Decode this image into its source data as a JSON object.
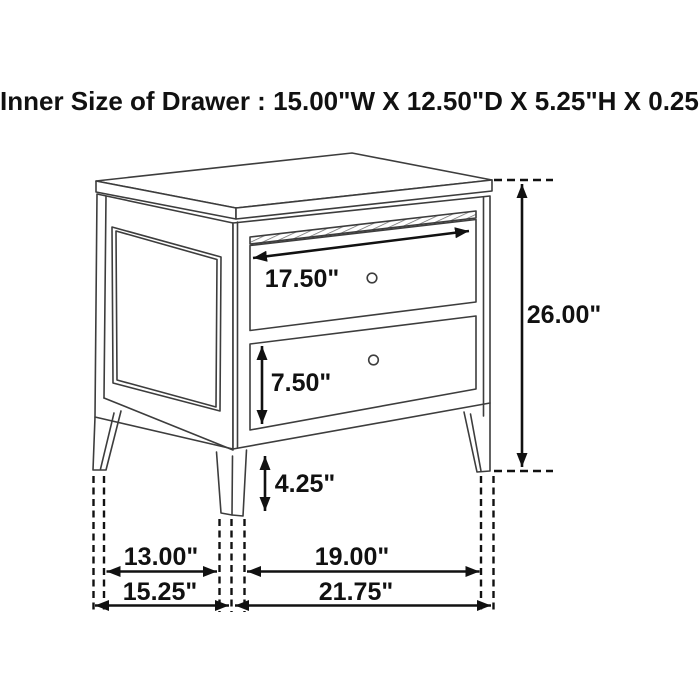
{
  "header": {
    "title": "Inner Size of Drawer : 15.00\"W X 12.50\"D X 5.25\"H X 0.25\"T"
  },
  "diagram": {
    "type": "furniture-dimension-line-drawing",
    "subject": "two-drawer nightstand",
    "drawer_count": 2,
    "dimensions": {
      "top_drawer_width": "17.50\"",
      "bottom_drawer_height": "7.50\"",
      "leg_height": "4.25\"",
      "overall_height": "26.00\"",
      "side_leg_spacing": "13.00\"",
      "front_leg_spacing": "19.00\"",
      "overall_depth": "15.25\"",
      "overall_width": "21.75\""
    },
    "colors": {
      "background": "#ffffff",
      "furniture_line": "#3d3d3d",
      "dimension_line": "#111111"
    }
  }
}
